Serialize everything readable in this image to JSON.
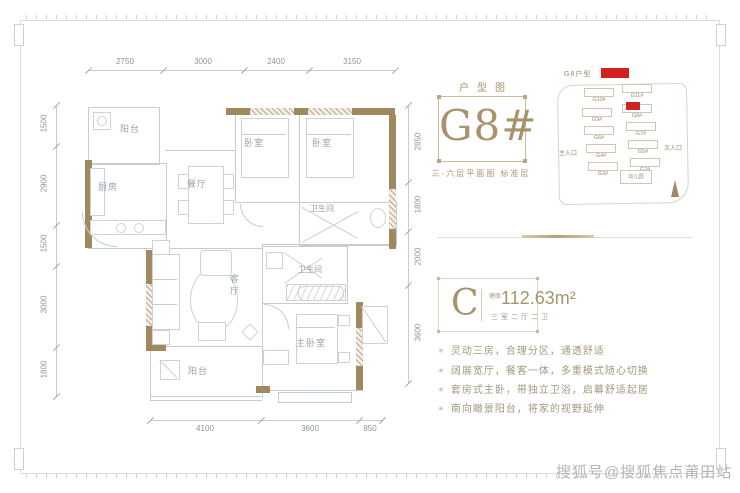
{
  "page": {
    "watermark": "搜狐号@搜狐焦点莆田站"
  },
  "colors": {
    "accent": "#a8936d",
    "wall": "#a1895f",
    "highlight_red": "#d0231f"
  },
  "plan": {
    "rooms": {
      "balcony_top": "阳台",
      "kitchen": "厨房",
      "dining": "餐厅",
      "bedroom_a": "卧室",
      "bedroom_b": "卧室",
      "bath_a": "卫生间",
      "bath_b": "卫生间",
      "living": "客厅",
      "master": "主卧室",
      "balcony_bottom": "阳台"
    },
    "dims_top": [
      "2750",
      "3000",
      "2400",
      "3150"
    ],
    "dims_left": [
      "1500",
      "2900",
      "1500",
      "3000",
      "1800"
    ],
    "dims_right": [
      "2850",
      "1800",
      "2000",
      "3600"
    ],
    "dims_bottom": [
      "4100",
      "3600",
      "850"
    ]
  },
  "info": {
    "plan_label": "户型图",
    "building_no": "G8#",
    "floor_note": "三-六层平面图 标准层",
    "unit": {
      "letter": "C",
      "area_prefix": "建面",
      "area": "112.63m²",
      "layout": "三室二厅二卫"
    },
    "bullet": "✳",
    "highlights": [
      "灵动三房，合理分区，通透舒适",
      "阔展宽厅，餐客一体，多重模式随心切换",
      "套房式主卧，带独立卫浴，启幕舒适起居",
      "南向瞰景阳台，将家的视野延伸"
    ]
  },
  "sitemap": {
    "legend_label": "G8户型",
    "entrance_main": "主入口",
    "entrance_side": "次入口",
    "kindergarten": "幼儿园",
    "buildings": [
      {
        "label": "G10#"
      },
      {
        "label": "G11#"
      },
      {
        "label": "G9#"
      },
      {
        "label": "G8#",
        "highlight": true
      },
      {
        "label": "G6#"
      },
      {
        "label": "G7#"
      },
      {
        "label": "G4#"
      },
      {
        "label": "G5#"
      },
      {
        "label": "G3#"
      },
      {
        "label": "G2#"
      }
    ]
  }
}
